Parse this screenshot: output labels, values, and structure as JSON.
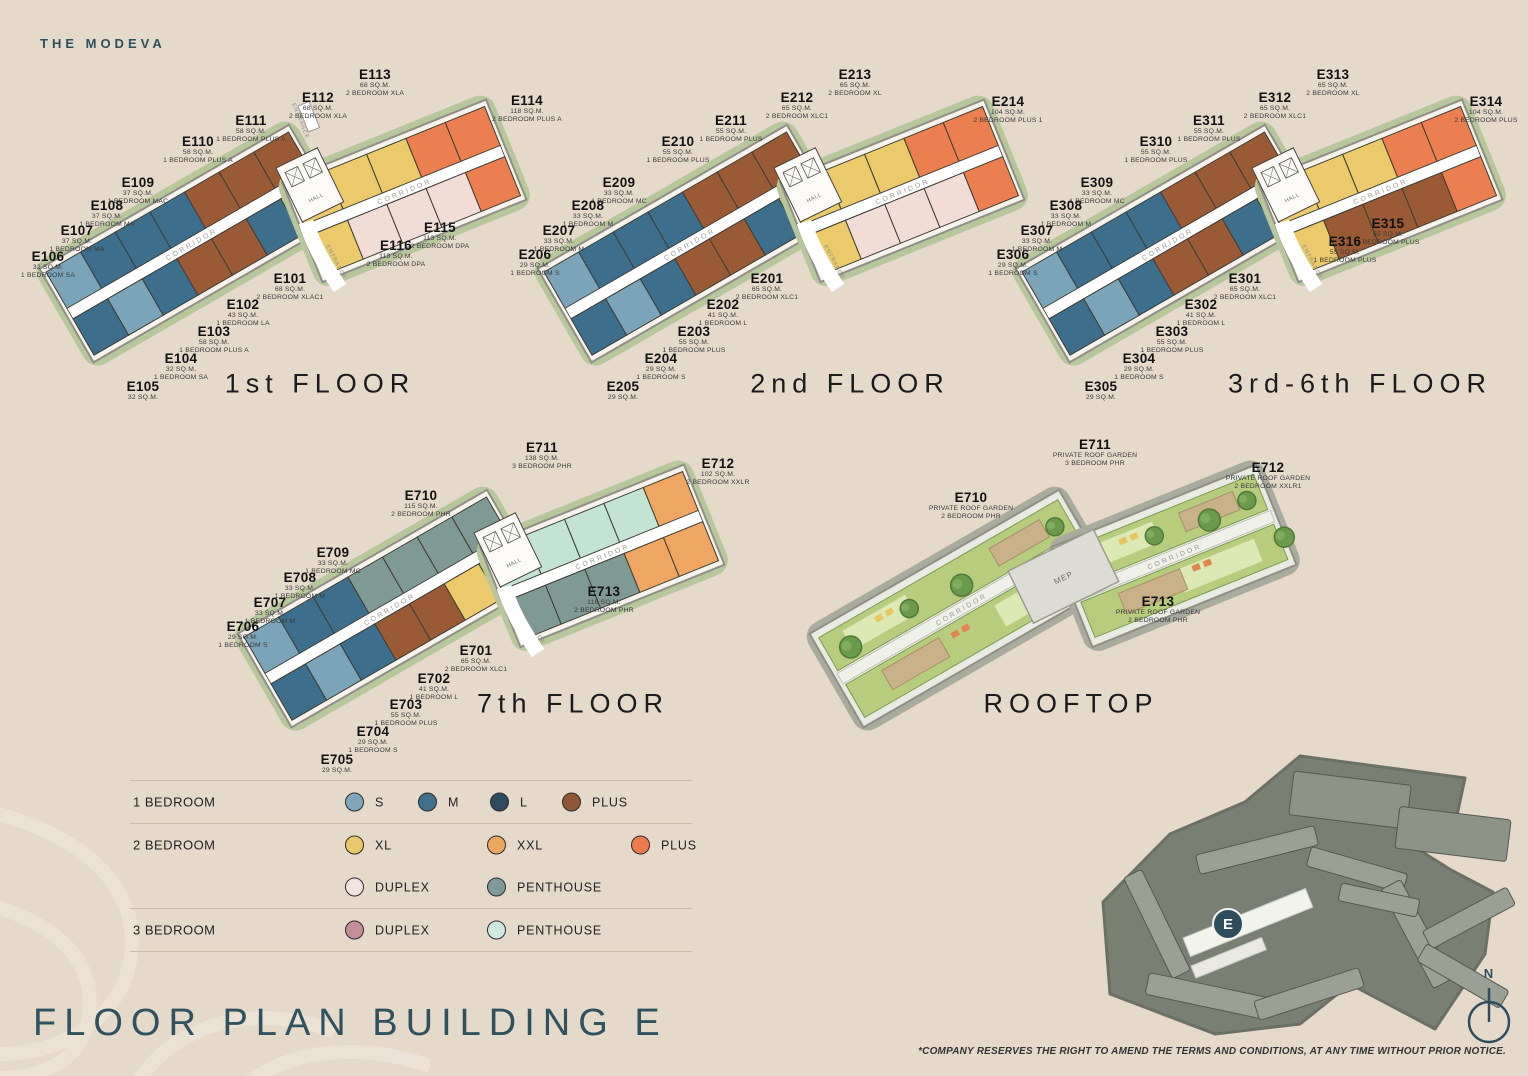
{
  "brand": "THE MODEVA",
  "page_title": "FLOOR PLAN BUILDING E",
  "disclaimer": "*COMPANY RESERVES THE RIGHT TO AMEND THE TERMS AND CONDITIONS,  AT ANY TIME WITHOUT PRIOR NOTICE.",
  "north_label": "N",
  "site_map": {
    "marker": "E"
  },
  "plan_labels": {
    "corridor": "CORRIDOR",
    "hall": "HALL",
    "entrance": "ENTRANCE",
    "mep": "MEP"
  },
  "colors": {
    "background": "#e5d9ca",
    "accent_teal": "#2e4d5e",
    "one_bed_s": "#7ba4b9",
    "one_bed_m": "#3d6e8c",
    "one_bed_l": "#2d4b61",
    "one_bed_plus": "#9a5a35",
    "two_bed_xl": "#eaca6b",
    "two_bed_xxl": "#efa663",
    "two_bed_plus": "#ec7f50",
    "two_bed_duplex": "#f2dcd6",
    "two_bed_penthouse": "#7f9a94",
    "three_bed_duplex": "#c48f9a",
    "three_bed_penthouse": "#c3e4d5"
  },
  "legend": {
    "rows": [
      {
        "label": "1 BEDROOM",
        "items": [
          {
            "name": "S",
            "color": "#7fa6ba"
          },
          {
            "name": "M",
            "color": "#40708c"
          },
          {
            "name": "L",
            "color": "#2d4a5f"
          },
          {
            "name": "PLUS",
            "color": "#8f5637"
          }
        ]
      },
      {
        "label": "2 BEDROOM",
        "items": [
          {
            "name": "XL",
            "color": "#e9c869"
          },
          {
            "name": "XXL",
            "color": "#eda75f"
          },
          {
            "name": "PLUS",
            "color": "#ec7c4e"
          }
        ]
      },
      {
        "label": "",
        "items": [
          {
            "name": "DUPLEX",
            "color": "#f3e3df"
          },
          {
            "name": "PENTHOUSE",
            "color": "#7f999a"
          }
        ]
      },
      {
        "label": "3 BEDROOM",
        "items": [
          {
            "name": "DUPLEX",
            "color": "#c18e99"
          },
          {
            "name": "PENTHOUSE",
            "color": "#cfe9de"
          }
        ]
      }
    ]
  },
  "floors": [
    {
      "title": "1st FLOOR",
      "units": [
        {
          "id": "E101",
          "lines": [
            "68 SQ.M.",
            "2 BEDROOM XLAC1"
          ]
        },
        {
          "id": "E102",
          "lines": [
            "43 SQ.M.",
            "1 BEDROOM LA"
          ]
        },
        {
          "id": "E103",
          "lines": [
            "58 SQ.M.",
            "1 BEDROOM PLUS A"
          ]
        },
        {
          "id": "E104",
          "lines": [
            "32 SQ.M.",
            "1 BEDROOM SA"
          ]
        },
        {
          "id": "E105",
          "lines": [
            "32 SQ.M."
          ]
        },
        {
          "id": "E106",
          "lines": [
            "32 SQ.M.",
            "1 BEDROOM SA"
          ]
        },
        {
          "id": "E107",
          "lines": [
            "37 SQ.M.",
            "1 BEDROOM MA"
          ]
        },
        {
          "id": "E108",
          "lines": [
            "37 SQ.M.",
            "1 BEDROOM MA"
          ]
        },
        {
          "id": "E109",
          "lines": [
            "37 SQ.M.",
            "1 BEDROOM MAC"
          ]
        },
        {
          "id": "E110",
          "lines": [
            "58 SQ.M.",
            "1 BEDROOM PLUS A"
          ]
        },
        {
          "id": "E111",
          "lines": [
            "58 SQ.M.",
            "1 BEDROOM PLUS A"
          ]
        },
        {
          "id": "E112",
          "lines": [
            "68 SQ.M.",
            "2 BEDROOM XLA"
          ]
        },
        {
          "id": "E113",
          "lines": [
            "68 SQ.M.",
            "2 BEDROOM XLA"
          ]
        },
        {
          "id": "E114",
          "lines": [
            "118 SQ.M.",
            "2 BEDROOM PLUS A"
          ]
        },
        {
          "id": "E115",
          "lines": [
            "113 SQ.M.",
            "2 BEDROOM DPA"
          ]
        },
        {
          "id": "E116",
          "lines": [
            "113 SQ.M.",
            "2 BEDROOM DPA"
          ]
        }
      ]
    },
    {
      "title": "2nd FLOOR",
      "units": [
        {
          "id": "E201",
          "lines": [
            "65 SQ.M.",
            "2 BEDROOM XLC1"
          ]
        },
        {
          "id": "E202",
          "lines": [
            "41 SQ.M.",
            "1 BEDROOM L"
          ]
        },
        {
          "id": "E203",
          "lines": [
            "55 SQ.M.",
            "1 BEDROOM PLUS"
          ]
        },
        {
          "id": "E204",
          "lines": [
            "29 SQ.M.",
            "1 BEDROOM S"
          ]
        },
        {
          "id": "E205",
          "lines": [
            "29 SQ.M."
          ]
        },
        {
          "id": "E206",
          "lines": [
            "29 SQ.M.",
            "1 BEDROOM S"
          ]
        },
        {
          "id": "E207",
          "lines": [
            "33 SQ.M.",
            "1 BEDROOM M"
          ]
        },
        {
          "id": "E208",
          "lines": [
            "33 SQ.M.",
            "1 BEDROOM M"
          ]
        },
        {
          "id": "E209",
          "lines": [
            "33 SQ.M.",
            "1 BEDROOM MC"
          ]
        },
        {
          "id": "E210",
          "lines": [
            "55 SQ.M.",
            "1 BEDROOM PLUS"
          ]
        },
        {
          "id": "E211",
          "lines": [
            "55 SQ.M.",
            "1 BEDROOM PLUS"
          ]
        },
        {
          "id": "E212",
          "lines": [
            "65 SQ.M.",
            "2 BEDROOM XLC1"
          ]
        },
        {
          "id": "E213",
          "lines": [
            "65 SQ.M.",
            "2 BEDROOM XL"
          ]
        },
        {
          "id": "E214",
          "lines": [
            "104 SQ.M.",
            "2 BEDROOM PLUS 1"
          ]
        }
      ]
    },
    {
      "title": "3rd-6th FLOOR",
      "units": [
        {
          "id": "E301",
          "lines": [
            "65 SQ.M.",
            "2 BEDROOM XLC1"
          ]
        },
        {
          "id": "E302",
          "lines": [
            "41 SQ.M.",
            "1 BEDROOM L"
          ]
        },
        {
          "id": "E303",
          "lines": [
            "55 SQ.M.",
            "1 BEDROOM PLUS"
          ]
        },
        {
          "id": "E304",
          "lines": [
            "29 SQ.M.",
            "1 BEDROOM S"
          ]
        },
        {
          "id": "E305",
          "lines": [
            "29 SQ.M."
          ]
        },
        {
          "id": "E306",
          "lines": [
            "29 SQ.M.",
            "1 BEDROOM S"
          ]
        },
        {
          "id": "E307",
          "lines": [
            "33 SQ.M.",
            "1 BEDROOM M"
          ]
        },
        {
          "id": "E308",
          "lines": [
            "33 SQ.M.",
            "1 BEDROOM M"
          ]
        },
        {
          "id": "E309",
          "lines": [
            "33 SQ.M.",
            "1 BEDROOM MC"
          ]
        },
        {
          "id": "E310",
          "lines": [
            "55 SQ.M.",
            "1 BEDROOM PLUS"
          ]
        },
        {
          "id": "E311",
          "lines": [
            "55 SQ.M.",
            "1 BEDROOM PLUS"
          ]
        },
        {
          "id": "E312",
          "lines": [
            "65 SQ.M.",
            "2 BEDROOM XLC1"
          ]
        },
        {
          "id": "E313",
          "lines": [
            "65 SQ.M.",
            "2 BEDROOM XL"
          ]
        },
        {
          "id": "E314",
          "lines": [
            "104 SQ.M.",
            "2 BEDROOM PLUS"
          ]
        },
        {
          "id": "E315",
          "lines": [
            "55 SQ.M.",
            "1 BEDROOM PLUS"
          ]
        },
        {
          "id": "E316",
          "lines": [
            "55 SQ.M.",
            "1 BEDROOM PLUS"
          ]
        }
      ]
    },
    {
      "title": "7th FLOOR",
      "units": [
        {
          "id": "E701",
          "lines": [
            "65 SQ.M.",
            "2 BEDROOM XLC1"
          ]
        },
        {
          "id": "E702",
          "lines": [
            "41 SQ.M.",
            "1 BEDROOM L"
          ]
        },
        {
          "id": "E703",
          "lines": [
            "55 SQ.M.",
            "1 BEDROOM PLUS"
          ]
        },
        {
          "id": "E704",
          "lines": [
            "29 SQ.M.",
            "1 BEDROOM S"
          ]
        },
        {
          "id": "E705",
          "lines": [
            "29 SQ.M."
          ]
        },
        {
          "id": "E706",
          "lines": [
            "29 SQ.M.",
            "1 BEDROOM S"
          ]
        },
        {
          "id": "E707",
          "lines": [
            "33 SQ.M.",
            "1 BEDROOM M"
          ]
        },
        {
          "id": "E708",
          "lines": [
            "33 SQ.M.",
            "1 BEDROOM M"
          ]
        },
        {
          "id": "E709",
          "lines": [
            "33 SQ.M.",
            "1 BEDROOM MC"
          ]
        },
        {
          "id": "E710",
          "lines": [
            "115 SQ.M.",
            "2 BEDROOM PHR"
          ]
        },
        {
          "id": "E711",
          "lines": [
            "138 SQ.M.",
            "3 BEDROOM PHR"
          ]
        },
        {
          "id": "E712",
          "lines": [
            "102 SQ.M.",
            "2 BEDROOM XXLR"
          ]
        },
        {
          "id": "E713",
          "lines": [
            "118 SQ.M.",
            "2 BEDROOM PHR"
          ]
        }
      ]
    },
    {
      "title": "ROOFTOP",
      "units": [
        {
          "id": "E710",
          "lines": [
            "PRIVATE ROOF GARDEN",
            "2 BEDROOM PHR"
          ]
        },
        {
          "id": "E711",
          "lines": [
            "PRIVATE ROOF GARDEN",
            "3 BEDROOM PHR"
          ]
        },
        {
          "id": "E712",
          "lines": [
            "PRIVATE ROOF GARDEN",
            "2 BEDROOM XXLR1"
          ]
        },
        {
          "id": "E713",
          "lines": [
            "PRIVATE ROOF GARDEN",
            "2 BEDROOM PHR"
          ]
        }
      ]
    }
  ]
}
